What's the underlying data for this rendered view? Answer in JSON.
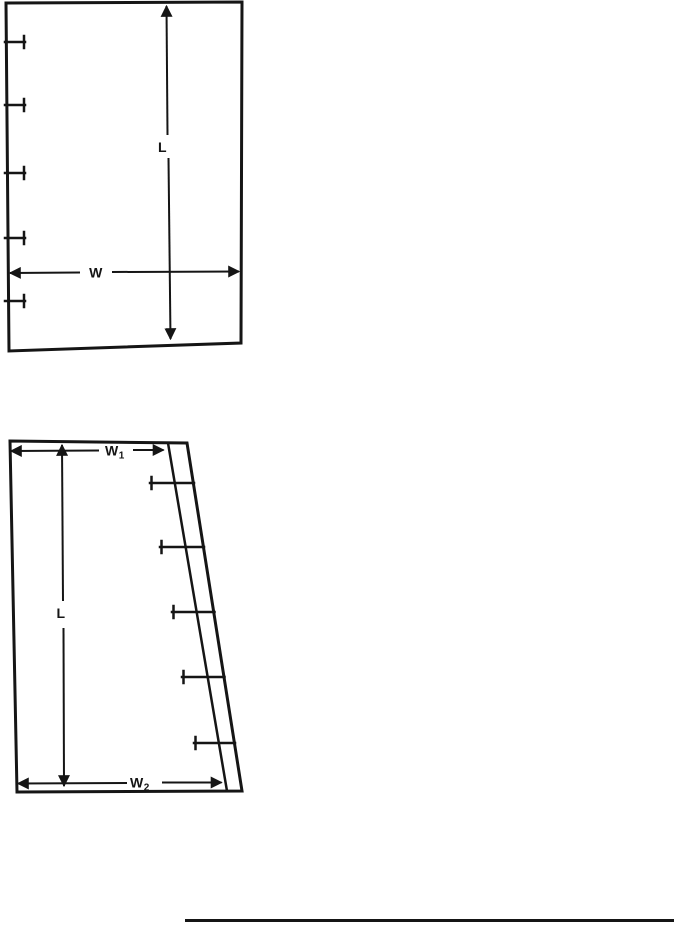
{
  "colors": {
    "ink": "#151515",
    "paper": "#ffffff"
  },
  "top_figure": {
    "length_label": "L",
    "width_label": "W",
    "fastener_count": 5
  },
  "bottom_figure": {
    "length_label": "L",
    "top_width_label": "W",
    "top_width_subscript": "1",
    "bottom_width_label": "W",
    "bottom_width_subscript": "2",
    "fastener_count": 5
  }
}
